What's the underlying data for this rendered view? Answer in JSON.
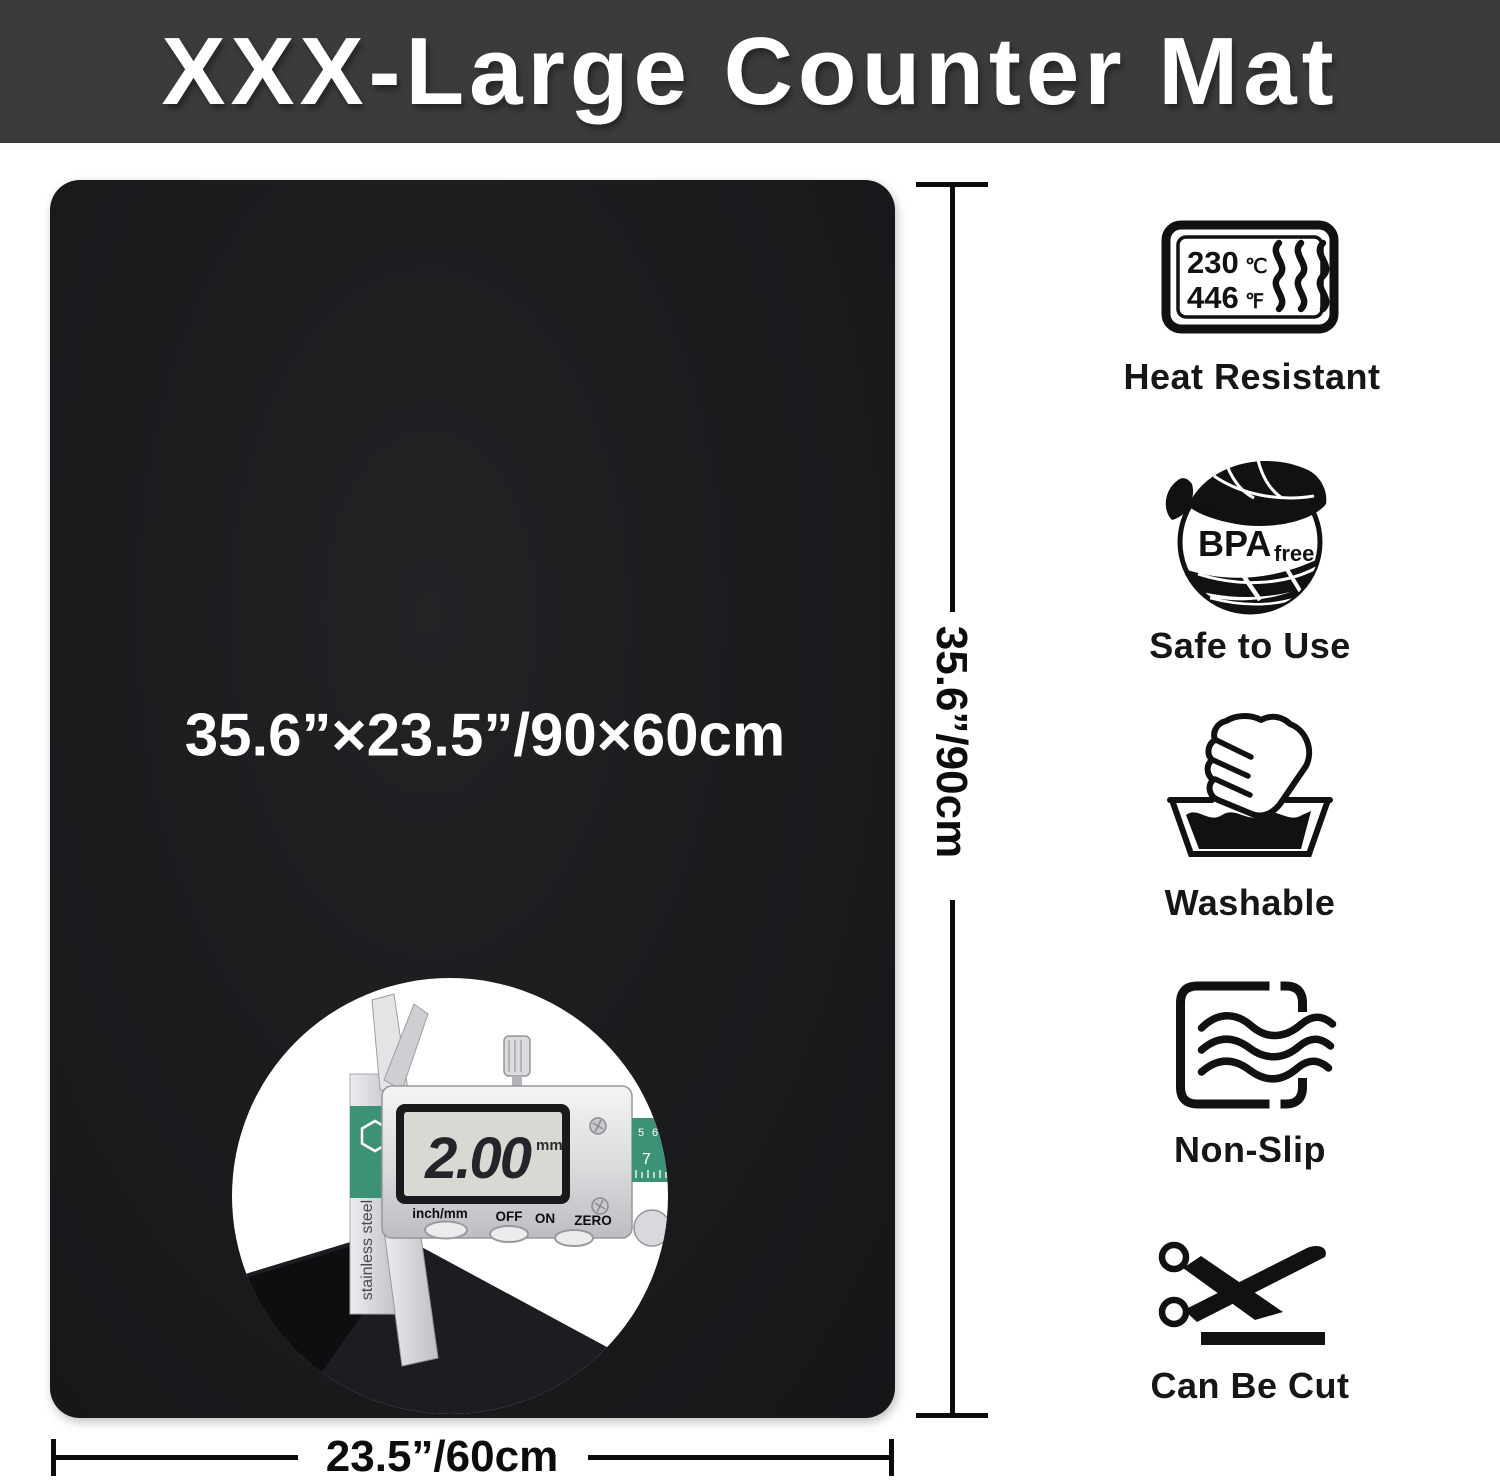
{
  "banner": {
    "title": "XXX-Large Counter Mat",
    "bg_color": "#3b3b3d",
    "text_color": "#ffffff"
  },
  "mat": {
    "size_label": "35.6”×23.5”/90×60cm",
    "thickness_label": "0.08”/2mm",
    "color": "#1b1b1e"
  },
  "dimensions": {
    "height_label": "35.6”/90cm",
    "width_label": "23.5”/60cm"
  },
  "inset": {
    "display_value": "2.00",
    "display_unit": "mm",
    "button_labels": {
      "mode": "inch/mm",
      "off": "OFF",
      "on": "ON",
      "zero": "ZERO"
    },
    "side_text": "stainless steel",
    "ruler_numbers": {
      "n1": "5",
      "n2": "6",
      "n3": "7"
    }
  },
  "features": [
    {
      "name": "heat-resistant",
      "label": "Heat Resistant",
      "temp_c": "230",
      "temp_c_unit": "℃",
      "temp_f": "446",
      "temp_f_unit": "℉"
    },
    {
      "name": "bpa-free",
      "label": "Safe to Use",
      "badge_main": "BPA",
      "badge_sub": "free"
    },
    {
      "name": "washable",
      "label": "Washable"
    },
    {
      "name": "non-slip",
      "label": "Non-Slip"
    },
    {
      "name": "can-be-cut",
      "label": "Can Be Cut"
    }
  ]
}
